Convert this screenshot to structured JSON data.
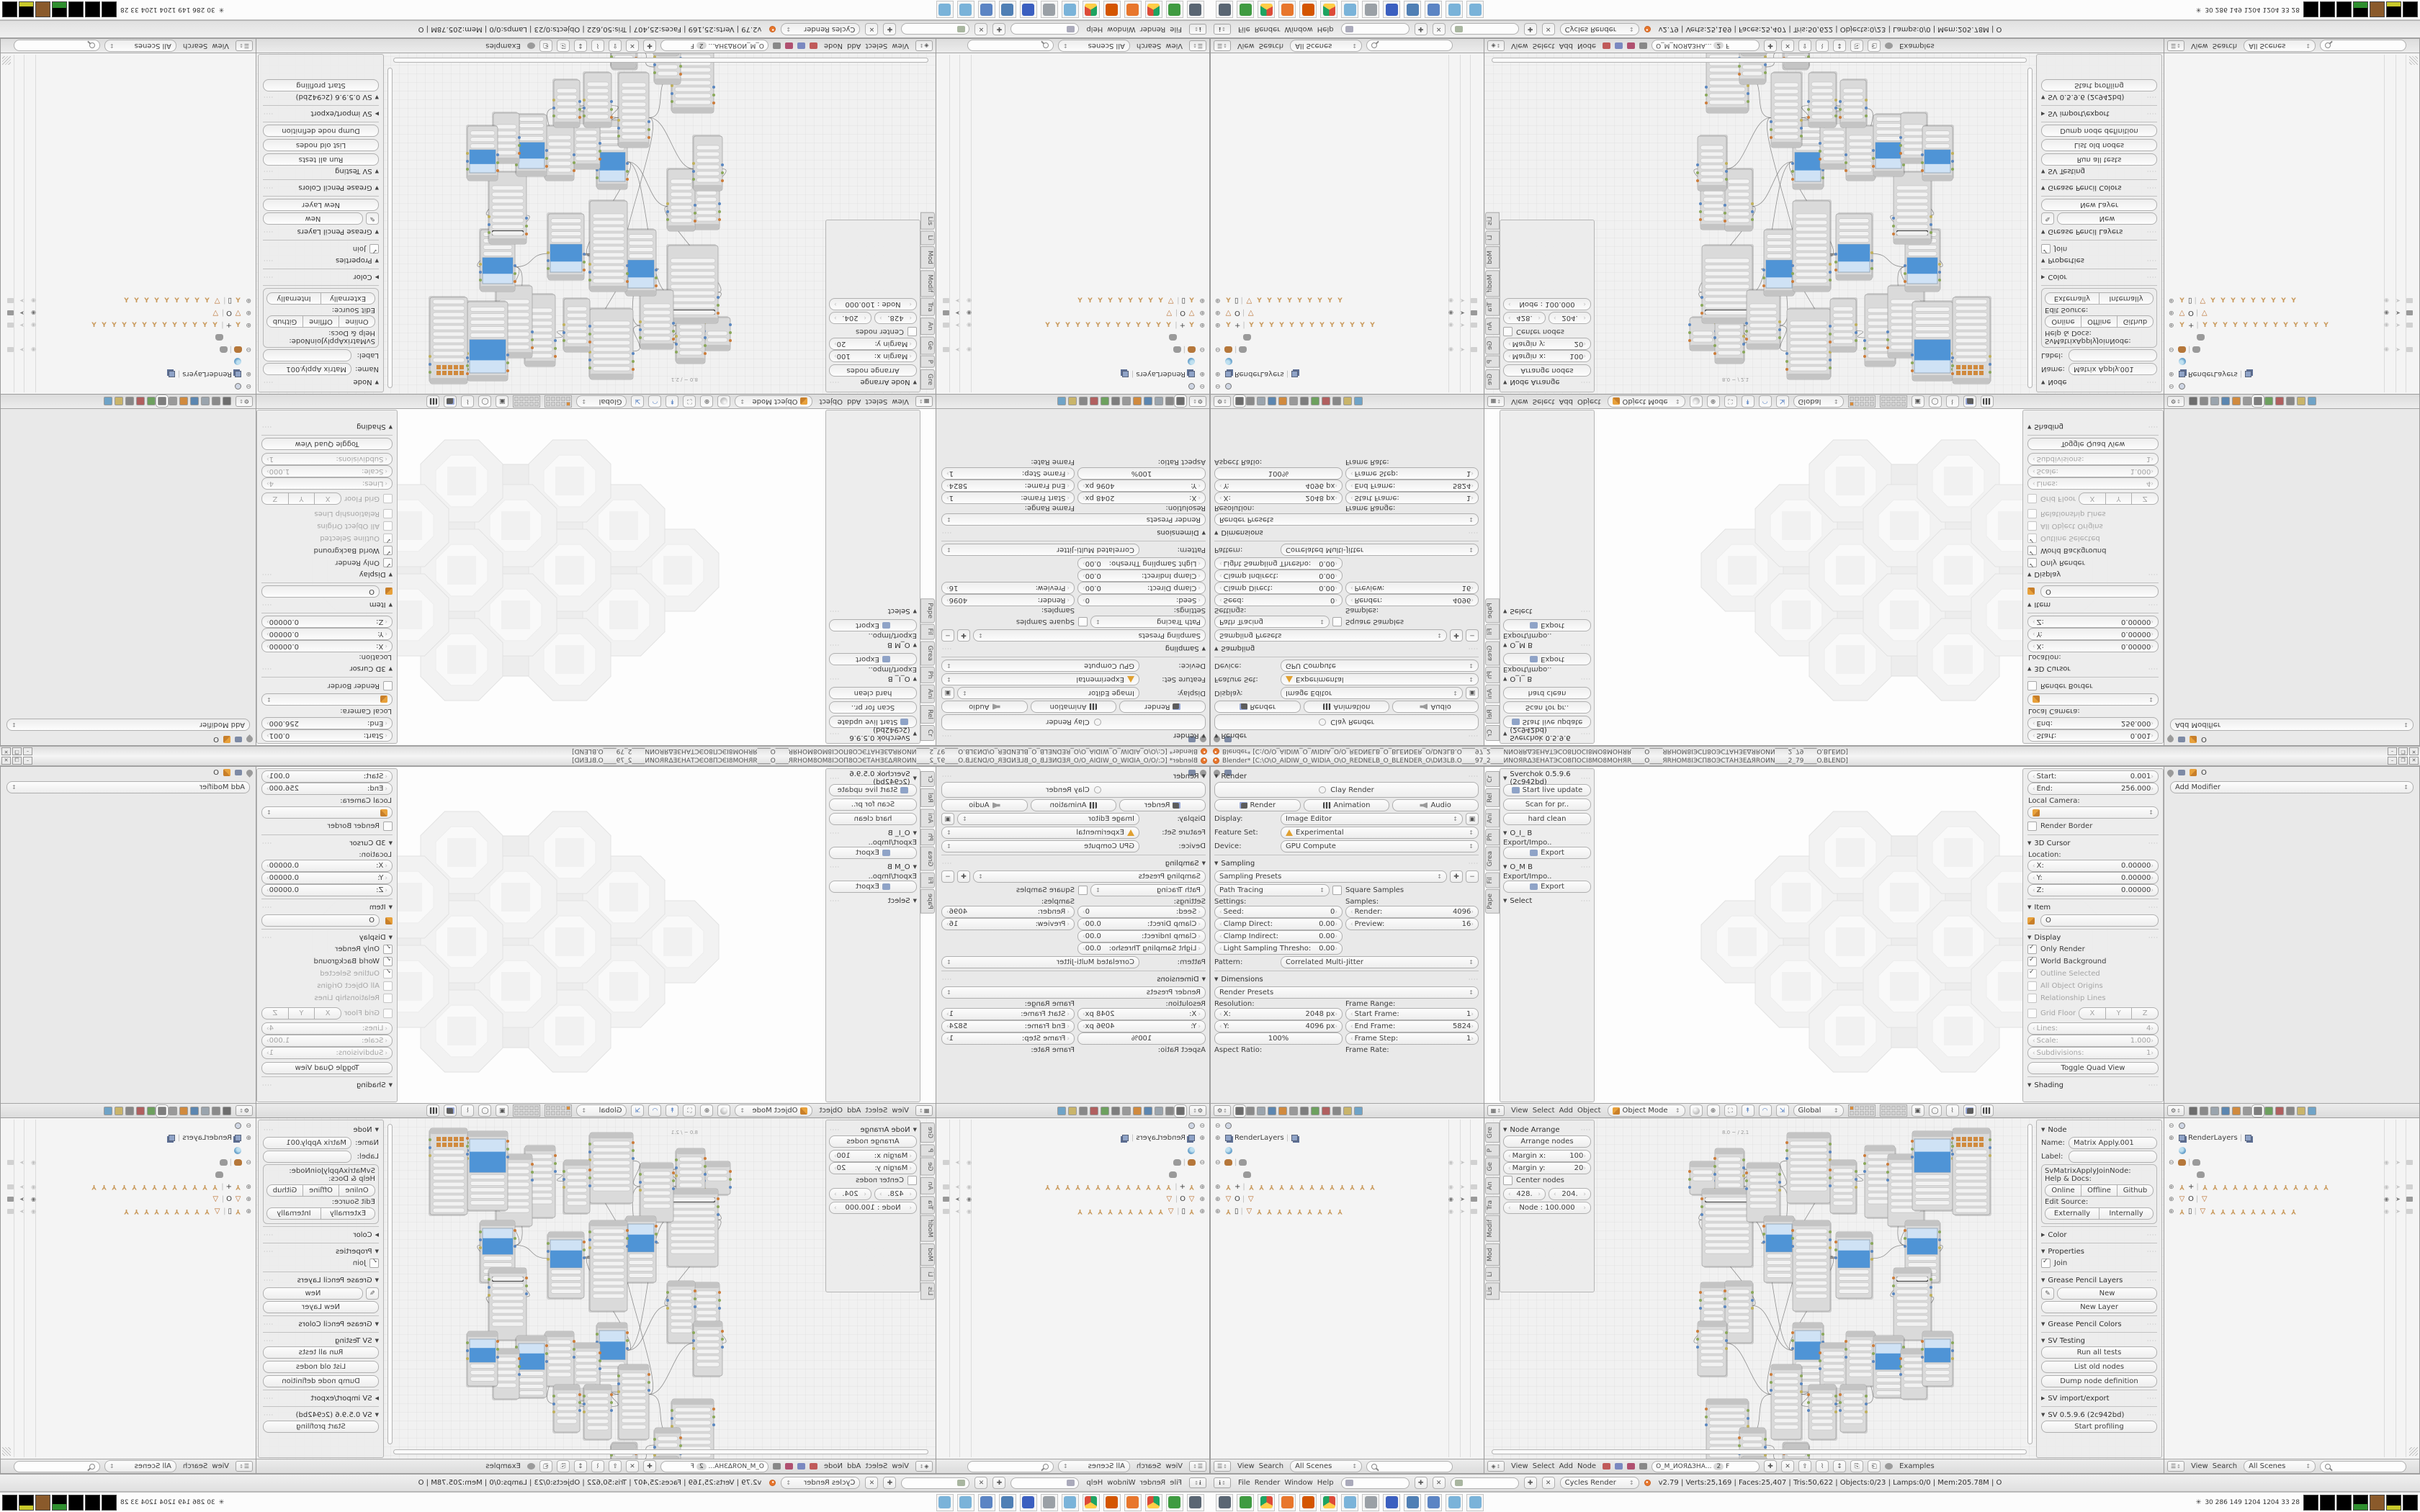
{
  "window": {
    "title": "Blender* [C:\\O\\O_AIDIW_O_WIDIA_O\\O_REDNELB_O_BLENDER_O\\DИЗLB.O____97_2____ИNОЯRΔЗЕНАТЭСО8ПОСI8МО8МОНЯR____О____ЯRНОМ8IЭСП8ОЭСТАНЗЕΔЯROИN____2_79____O.BLEND]",
    "minimize": "–",
    "maximize": "❐",
    "close": "✕"
  },
  "render_props": {
    "render_panel": "Render",
    "clay": "Clay Render",
    "render_btn": "Render",
    "animation_btn": "Animation",
    "audio_btn": "Audio",
    "display_label": "Display:",
    "display_value": "Image Editor",
    "feature_label": "Feature Set:",
    "feature_value": "Experimental",
    "device_label": "Device:",
    "device_value": "GPU Compute",
    "sampling_panel": "Sampling",
    "presets": "Sampling Presets",
    "integrator": "Path Tracing",
    "square": "Square Samples",
    "settings_label": "Settings:",
    "seed": "Seed:",
    "seed_v": "0",
    "clampd": "Clamp Direct:",
    "clampd_v": "0.00",
    "clampi": "Clamp Indirect:",
    "clampi_v": "0.00",
    "lst": "Light Sampling Thresho:",
    "lst_v": "0.00",
    "samples_label": "Samples:",
    "rsamp": "Render:",
    "rsamp_v": "4096",
    "psamp": "Preview:",
    "psamp_v": "16",
    "pattern": "Pattern:",
    "pattern_v": "Correlated Multi-Jitter",
    "dim_panel": "Dimensions",
    "dim_presets": "Render Presets",
    "res_label": "Resolution:",
    "resx": "X:",
    "resx_v": "2048 px",
    "resy": "Y:",
    "resy_v": "4096 px",
    "pct": "100%",
    "range_label": "Frame Range:",
    "sf": "Start Frame:",
    "sf_v": "1",
    "ef": "End Frame:",
    "ef_v": "5824",
    "fs": "Frame Step:",
    "fs_v": "1",
    "aspect": "Aspect Ratio:",
    "framerate": "Frame Rate:"
  },
  "vp": {
    "tshelf": {
      "title": "Sverchok 0.5.9.6 (2c942bd)",
      "b1": "Start live update",
      "b2": "Scan for pr..",
      "b3": "hard clean",
      "p1": "O_I_ B",
      "exp_lbl": "Export/Impo..",
      "export": "Export",
      "p2": "O_M B",
      "p3": "Select",
      "tabs": [
        "Cr",
        "Rel",
        "Ani",
        "Ph",
        "Grea",
        "Fil",
        "Pape"
      ]
    },
    "np": {
      "start": "Start:",
      "start_v": "0.001",
      "end": "End:",
      "end_v": "256.000",
      "localcam": "Local Camera:",
      "rb": "Render Border",
      "cursor3d": "3D Cursor",
      "loc": "Location:",
      "x": "X:",
      "y": "Y:",
      "z": "Z:",
      "zero": "0.00000",
      "item": "Item",
      "obj": "O",
      "display": "Display",
      "onlyr": "Only Render",
      "worldbg": "World Background",
      "outline": "Outline Selected",
      "origins": "All Object Origins",
      "rel": "Relationship Lines",
      "grid": "Grid Floor",
      "gx": "X",
      "gy": "Y",
      "gz": "Z",
      "lines": "Lines:",
      "lines_v": "4",
      "scale": "Scale:",
      "scale_v": "1.000",
      "subd": "Subdivisions:",
      "subd_v": "1",
      "quad": "Toggle Quad View",
      "shading": "Shading"
    },
    "header": {
      "menus": [
        "View",
        "Select",
        "Add",
        "Object"
      ],
      "mode": "Object Mode",
      "orient": "Global"
    }
  },
  "modp": {
    "obj": "O",
    "add": "Add Modifier"
  },
  "outliner": {
    "menus": [
      "View",
      "Search"
    ],
    "scene": "All Scenes",
    "rows": [
      {
        "exp": "⊖",
        "ic": "link",
        "lb": "",
        "dups": [],
        "tg": ""
      },
      {
        "exp": "⊕",
        "ic": "rl",
        "lb": "RenderLayers",
        "dups": [
          "rl"
        ],
        "tg": ""
      },
      {
        "exp": "",
        "ic": "world",
        "lb": "",
        "dups": [],
        "tg": ""
      },
      {
        "exp": "⊖",
        "ic": "monkey",
        "lb": "",
        "dups": [
          "monkeyg"
        ],
        "tg": "dim"
      },
      {
        "exp": "",
        "ic": "monkeyg",
        "lb": "",
        "dups": [],
        "tg": "",
        "child": true
      },
      {
        "exp": "⊕",
        "ic": "y",
        "lb": "+",
        "dups": [
          "y",
          "y",
          "y",
          "y",
          "y",
          "y",
          "y",
          "y",
          "y",
          "y",
          "y",
          "y",
          "y"
        ],
        "tg": "dim"
      },
      {
        "exp": "⊕",
        "ic": "tri",
        "lb": "O",
        "dups": [
          "tri"
        ],
        "tg": "strong"
      },
      {
        "exp": "⊕",
        "ic": "y",
        "lb": "▯",
        "dups": [
          "tri",
          "y",
          "y",
          "y",
          "y",
          "y",
          "y",
          "y",
          "y",
          "y"
        ],
        "tg": "dim"
      }
    ]
  },
  "node_ed": {
    "header": {
      "menus": [
        "View",
        "Select",
        "Add",
        "Node"
      ],
      "tree": "O_M_ИОЯΔЗНА...",
      "users": "2",
      "fake": "F",
      "examples": "Examples"
    },
    "tshelf": {
      "title": "Node Arrange",
      "arrange": "Arrange nodes",
      "mx": "Margin x:",
      "mx_v": "100",
      "my": "Margin y:",
      "my_v": "20",
      "center": "Center nodes",
      "f1": "428.",
      "f2": "204.",
      "f3": "Node : 100.000",
      "tabs": [
        "Gre",
        "P",
        "Ge",
        "An",
        "Tra",
        "Modif",
        "Mod",
        "Li",
        "Lis"
      ]
    },
    "np": {
      "node": "Node",
      "name": "Name:",
      "name_v": "Matrix Apply.001",
      "label": "Label:",
      "cls": "SvMatrixApplyJoinNode:",
      "help": "Help & Docs:",
      "online": "Online",
      "offline": "Offline",
      "github": "Github",
      "editsrc": "Edit Source:",
      "ext": "Externally",
      "int": "Internally",
      "color": "Color",
      "props": "Properties",
      "join": "Join",
      "gpl": "Grease Pencil Layers",
      "new": "New",
      "newlayer": "New Layer",
      "gpc": "Grease Pencil Colors",
      "svt": "SV Testing",
      "runall": "Run all tests",
      "listold": "List old nodes",
      "dump": "Dump node definition",
      "svie": "SV import/export",
      "svver": "SV 0.5.9.6 (2c942bd)",
      "profiling": "Start profiling"
    },
    "canvas_note": "8.0 ~ / 2.1"
  },
  "info": {
    "menus": [
      "File",
      "Render",
      "Window",
      "Help"
    ],
    "engine": "Cycles Render",
    "stats": "v2.79 | Verts:25,169 | Faces:25,407 | Tris:50,622 | Objects:0/23 | Lamps:0/0 | Mem:205.78M | O"
  },
  "taskbar": {
    "tray": "30  286  149  1204 1204  33  28"
  },
  "graph": {
    "nodes": [
      [
        285,
        60,
        36,
        46,
        "p"
      ],
      [
        320,
        42,
        40,
        72,
        "p"
      ],
      [
        302,
        98,
        70,
        108,
        "d"
      ],
      [
        364,
        62,
        46,
        82,
        "p"
      ],
      [
        420,
        20,
        60,
        98,
        "p"
      ],
      [
        388,
        136,
        42,
        92,
        "b"
      ],
      [
        428,
        142,
        52,
        126,
        "p"
      ],
      [
        480,
        58,
        36,
        74,
        "p"
      ],
      [
        488,
        158,
        50,
        92,
        "b"
      ],
      [
        528,
        38,
        42,
        100,
        "p"
      ],
      [
        560,
        50,
        50,
        100,
        "p"
      ],
      [
        594,
        18,
        56,
        110,
        "b"
      ],
      [
        650,
        14,
        52,
        120,
        "g"
      ],
      [
        584,
        142,
        48,
        86,
        "b"
      ],
      [
        568,
        208,
        52,
        100,
        "d"
      ],
      [
        300,
        228,
        36,
        66,
        "p"
      ],
      [
        334,
        226,
        38,
        86,
        "p"
      ],
      [
        296,
        282,
        40,
        76,
        "p"
      ],
      [
        428,
        284,
        42,
        96,
        "b"
      ],
      [
        466,
        312,
        38,
        80,
        "p"
      ],
      [
        502,
        296,
        40,
        76,
        "p"
      ],
      [
        540,
        302,
        42,
        86,
        "b"
      ],
      [
        578,
        320,
        36,
        70,
        "p"
      ],
      [
        608,
        296,
        42,
        76,
        "b"
      ],
      [
        398,
        342,
        42,
        104,
        "p"
      ],
      [
        450,
        370,
        38,
        76,
        "p"
      ],
      [
        494,
        370,
        36,
        66,
        "p"
      ],
      [
        308,
        390,
        58,
        122,
        "p"
      ],
      [
        354,
        430,
        36,
        60,
        "p"
      ],
      [
        414,
        450,
        36,
        64,
        "p"
      ],
      [
        356,
        470,
        36,
        50,
        "p"
      ],
      [
        416,
        452,
        34,
        46,
        "p"
      ]
    ],
    "wires": [
      [
        0,
        1
      ],
      [
        1,
        3
      ],
      [
        1,
        2
      ],
      [
        2,
        3
      ],
      [
        3,
        4
      ],
      [
        4,
        7
      ],
      [
        7,
        9
      ],
      [
        9,
        10
      ],
      [
        10,
        11
      ],
      [
        11,
        12
      ],
      [
        10,
        12
      ],
      [
        9,
        13
      ],
      [
        10,
        13
      ],
      [
        13,
        14
      ],
      [
        4,
        6
      ],
      [
        3,
        6
      ],
      [
        6,
        5
      ],
      [
        5,
        8
      ],
      [
        6,
        8
      ],
      [
        8,
        13
      ],
      [
        15,
        16
      ],
      [
        16,
        2
      ],
      [
        15,
        17
      ],
      [
        17,
        24
      ],
      [
        16,
        18
      ],
      [
        6,
        18
      ],
      [
        18,
        19
      ],
      [
        19,
        20
      ],
      [
        20,
        21
      ],
      [
        21,
        22
      ],
      [
        22,
        23
      ],
      [
        21,
        23
      ],
      [
        24,
        25
      ],
      [
        25,
        26
      ],
      [
        24,
        19
      ],
      [
        27,
        24
      ],
      [
        27,
        28
      ],
      [
        28,
        29
      ],
      [
        29,
        30
      ],
      [
        14,
        21
      ],
      [
        2,
        18
      ],
      [
        26,
        21
      ],
      [
        5,
        24
      ]
    ]
  }
}
